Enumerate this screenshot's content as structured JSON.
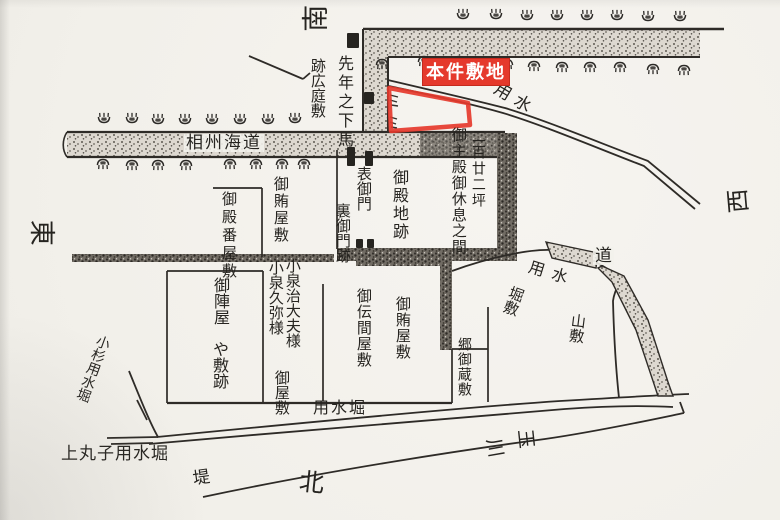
{
  "map": {
    "highlight": {
      "label": "本件敷地"
    },
    "compass": {
      "north": "北",
      "south": "南",
      "east": "東",
      "west": "西"
    },
    "roads": {
      "sagami_kaido": "相州海道",
      "michi": "道"
    },
    "waterways": {
      "yosui_upper": "用水",
      "yosui_lower": "用水",
      "yosui_bori": "用水堀",
      "kosugi_yosui_bori": "小杉用水堀",
      "kamimaruko_yosui_bori": "上丸子用水堀",
      "tsutsumi": "堤",
      "river": {
        "char_first": "玉",
        "char_second": "川"
      }
    },
    "parcels": {
      "ato_hiroba_shiki": "跡広庭敷",
      "sennen_no_geba": "先年之下馬",
      "goten_ban_yashiki": "御殿番屋敷",
      "omakanai_yashiki_upper": "御賄屋敷",
      "omote_gomon": "表御門",
      "ura_gomon_ato": "裏御門跡",
      "goten_chi_ato": "御殿地跡",
      "goshuden_kyusoku": "御主殿御休息之間",
      "tsubo_222": "二百廿二坪",
      "ojinya": "御陣屋",
      "ya_shiki_ato": "や敷跡",
      "koizumi_jidayu": "小泉治大夫様",
      "koizumi_kyuya": "小泉久弥様",
      "oyashiki": "御屋敷",
      "odenma_yashiki": "御伝間屋敷",
      "omakanai_yashiki_lower": "御賄屋敷",
      "go_okura_shiki": "郷御蔵敷",
      "horishiki": "堀敷",
      "yamashiki": "山敷"
    }
  }
}
